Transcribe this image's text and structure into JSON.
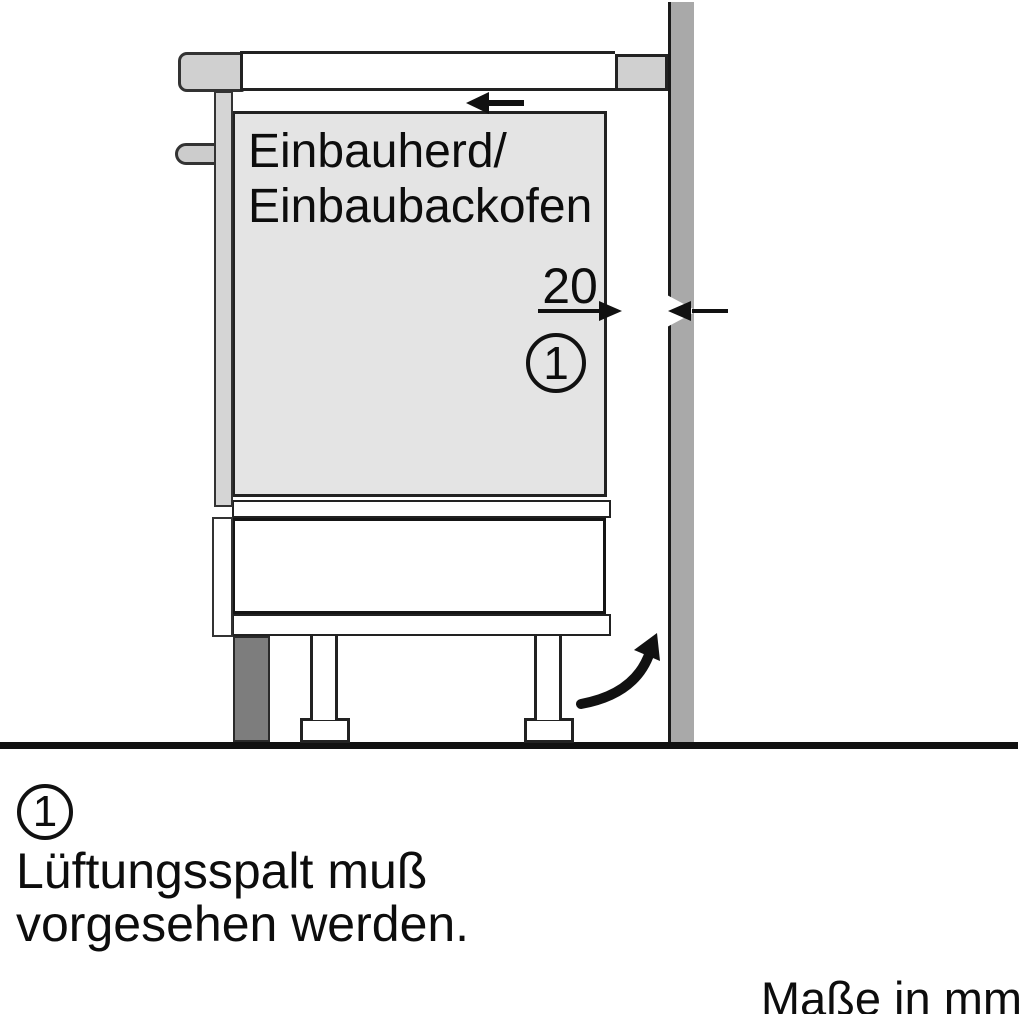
{
  "diagram": {
    "appliance_label": {
      "line1": "Einbauherd/",
      "line2": "Einbaubackofen"
    },
    "gap_dimension": {
      "value": "20",
      "callout_number": "1"
    },
    "icons": {
      "push_back_arrow": "arrow-left",
      "dimension_arrow_right": "arrow-right",
      "dimension_arrow_left": "arrow-left",
      "airflow_arrow": "curved-arrow-up-right"
    },
    "colors": {
      "outline": "#1a1a1a",
      "appliance_fill": "#e4e4e4",
      "cabinet_fill": "#d2d2d2",
      "wall_fill": "#a9a9a9",
      "plinth_fill": "#7d7d7d"
    }
  },
  "legend": {
    "callout_number": "1",
    "line1": "Lüftungsspalt muß",
    "line2": "vorgesehen werden."
  },
  "footer": {
    "units_note": "Maße in mm"
  }
}
